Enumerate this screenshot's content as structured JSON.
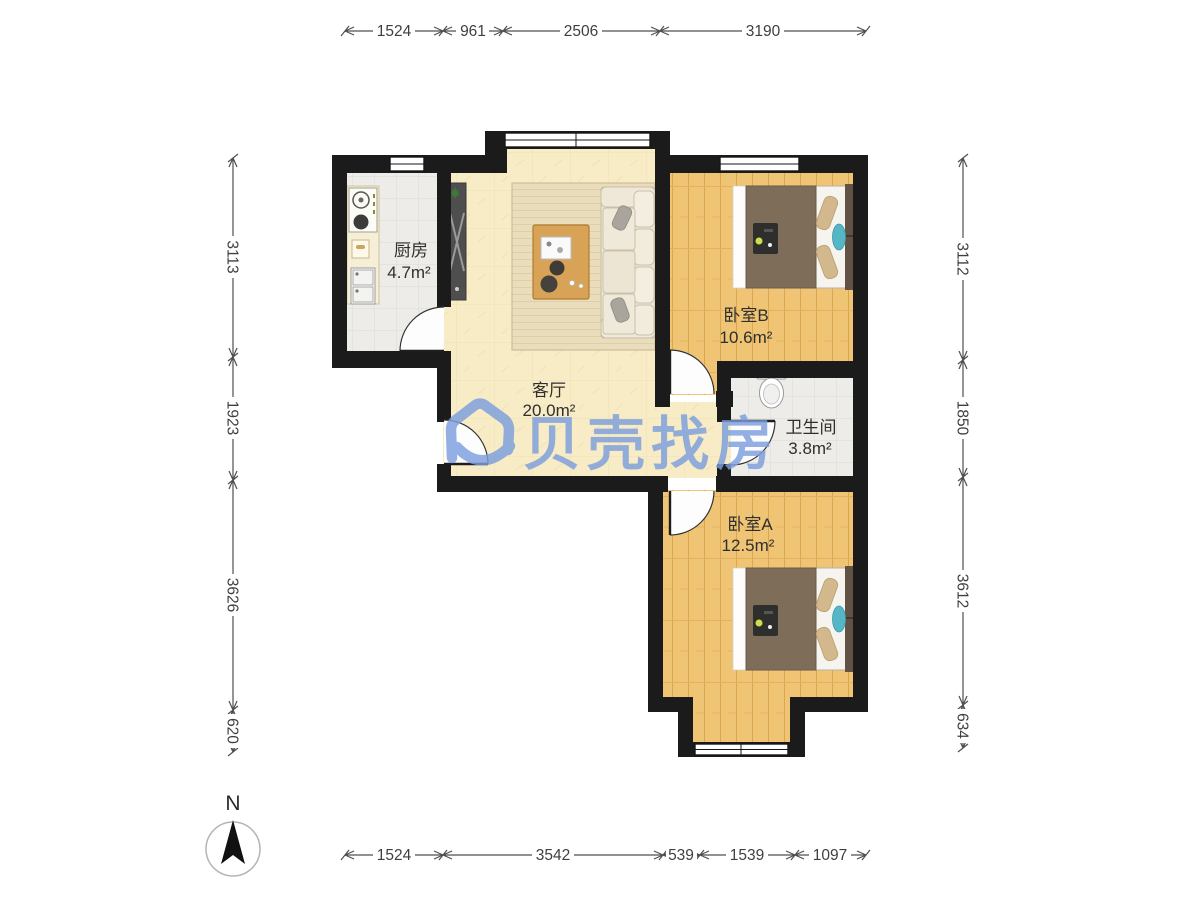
{
  "watermark": {
    "brand": "贝壳找房"
  },
  "compass": {
    "label": "N"
  },
  "rooms": {
    "kitchen": {
      "name": "厨房",
      "area": "4.7m²"
    },
    "living": {
      "name": "客厅",
      "area": "20.0m²"
    },
    "bedroom_b": {
      "name": "卧室B",
      "area": "10.6m²"
    },
    "bathroom": {
      "name": "卫生间",
      "area": "3.8m²"
    },
    "bedroom_a": {
      "name": "卧室A",
      "area": "12.5m²"
    }
  },
  "dimensions_mm": {
    "top": [
      "1524",
      "961",
      "2506",
      "3190"
    ],
    "bottom": [
      "1524",
      "3542",
      "539",
      "1539",
      "1097"
    ],
    "left": [
      "3113",
      "1923",
      "3626",
      "620"
    ],
    "right": [
      "3112",
      "1850",
      "3612",
      "634"
    ]
  },
  "colors": {
    "wall": "#1b1b1b",
    "living_floor": "#f8ecc6",
    "wood_floor": "#f0c475",
    "tile_floor": "#edece8",
    "watermark_blue": "#7c9ede",
    "dim_text": "#3f3f3f"
  }
}
